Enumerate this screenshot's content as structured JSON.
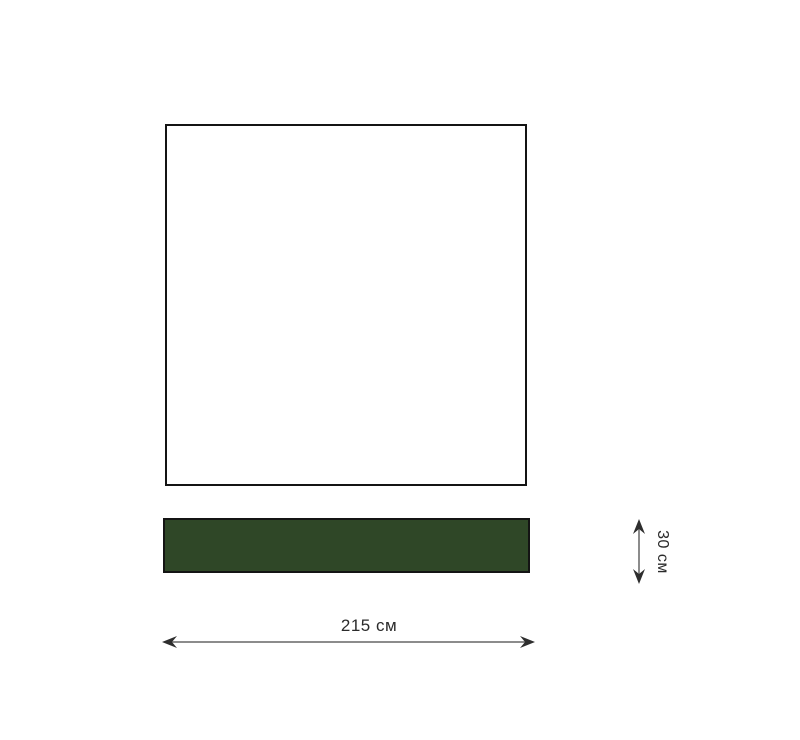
{
  "diagram": {
    "panel": {
      "name": "large square panel",
      "fill": "#ffffff",
      "stroke": "#141414"
    },
    "base_bar": {
      "name": "green base bar",
      "fill": "#2f4727",
      "stroke": "#141414"
    },
    "dimension_width": {
      "label": "215 см"
    },
    "dimension_height": {
      "label": "30 см"
    },
    "arrow": {
      "line_color": "#8c8c8c",
      "head_color": "#2e2e2e"
    },
    "label_color": "#2b2b2b"
  }
}
